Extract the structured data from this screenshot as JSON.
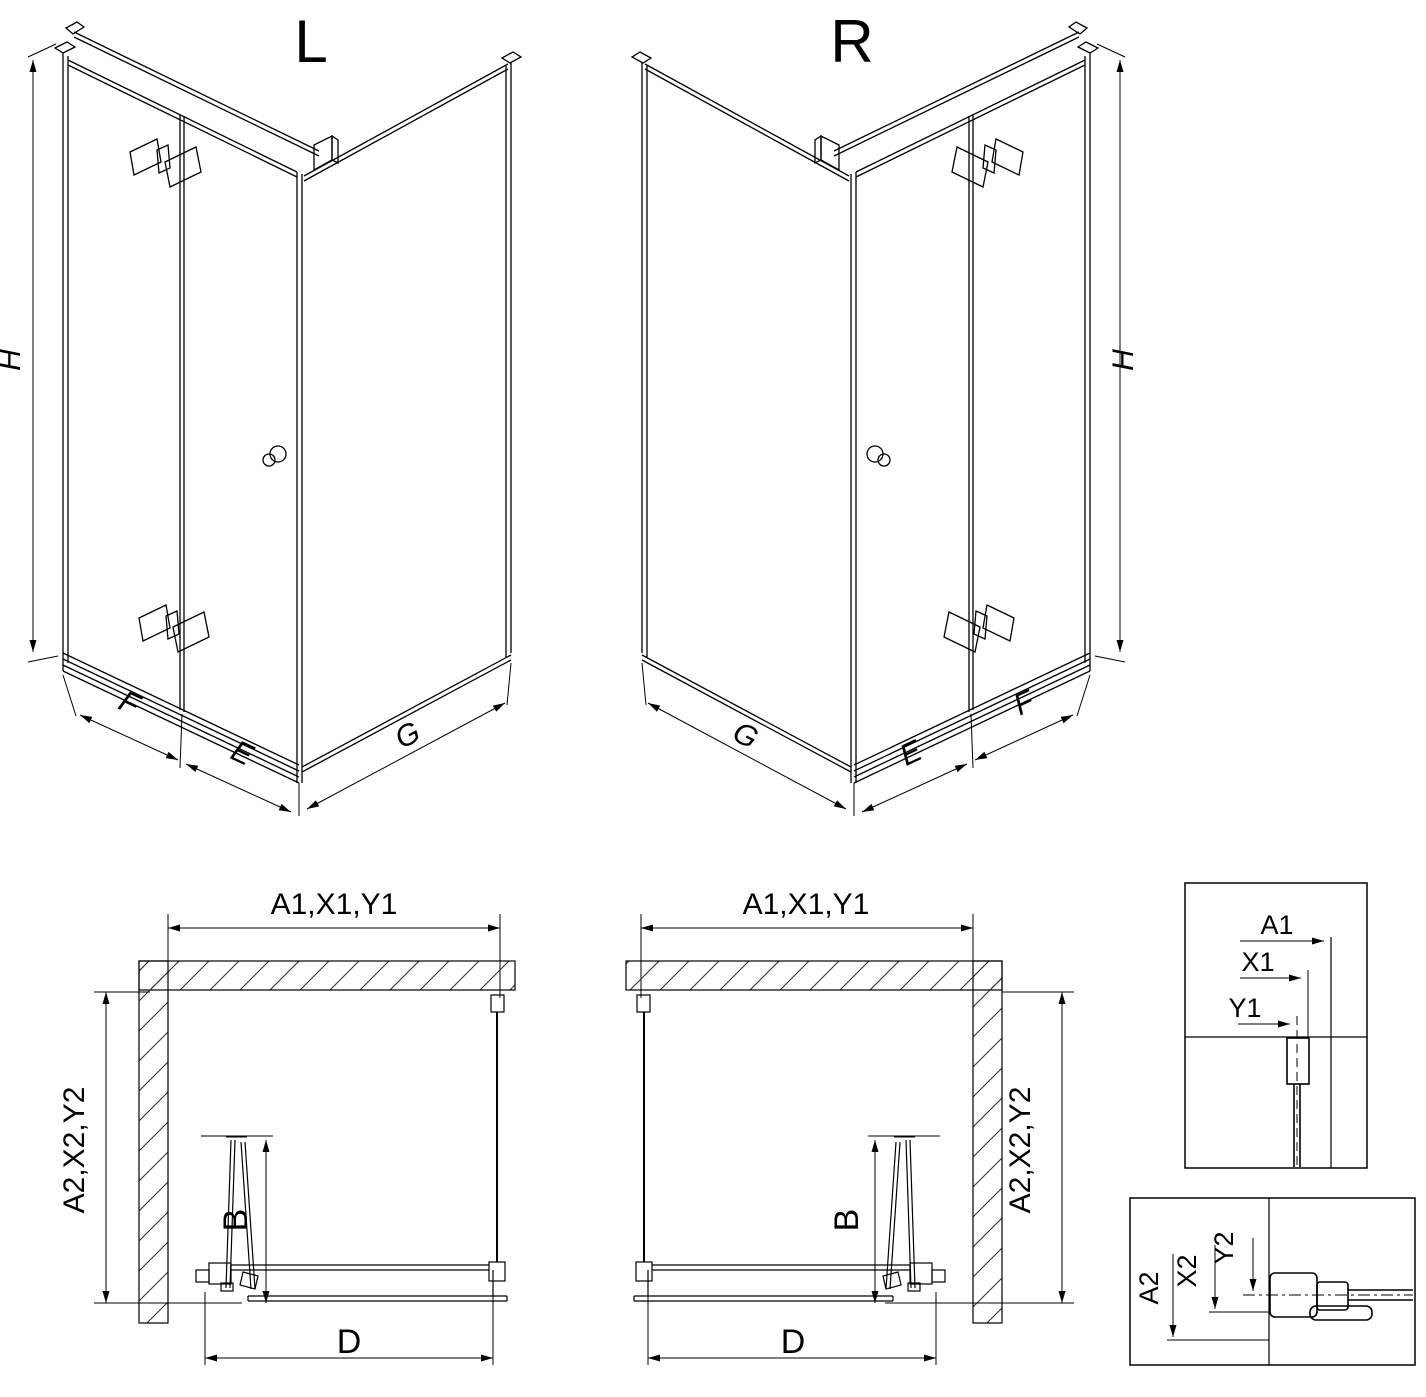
{
  "page": {
    "background": "#ffffff",
    "line_color": "#000000",
    "description": "Technical drawing of corner shower enclosure, left (L) and right (R) versions, with plan views and mounting-dimension details"
  },
  "views": {
    "iso_left": {
      "title": "L",
      "dims": {
        "height": "H",
        "front": "F",
        "door": "E",
        "side": "G"
      }
    },
    "iso_right": {
      "title": "R",
      "dims": {
        "height": "H",
        "front": "F",
        "door": "E",
        "side": "G"
      }
    },
    "plan_left": {
      "width": "A1,X1,Y1",
      "depth": "A2,X2,Y2",
      "fold": "B",
      "opening": "D"
    },
    "plan_right": {
      "width": "A1,X1,Y1",
      "depth": "A2,X2,Y2",
      "fold": "B",
      "opening": "D"
    },
    "detail_width": {
      "labels": [
        "A1",
        "X1",
        "Y1"
      ]
    },
    "detail_depth": {
      "labels": [
        "A2",
        "X2",
        "Y2"
      ]
    }
  }
}
